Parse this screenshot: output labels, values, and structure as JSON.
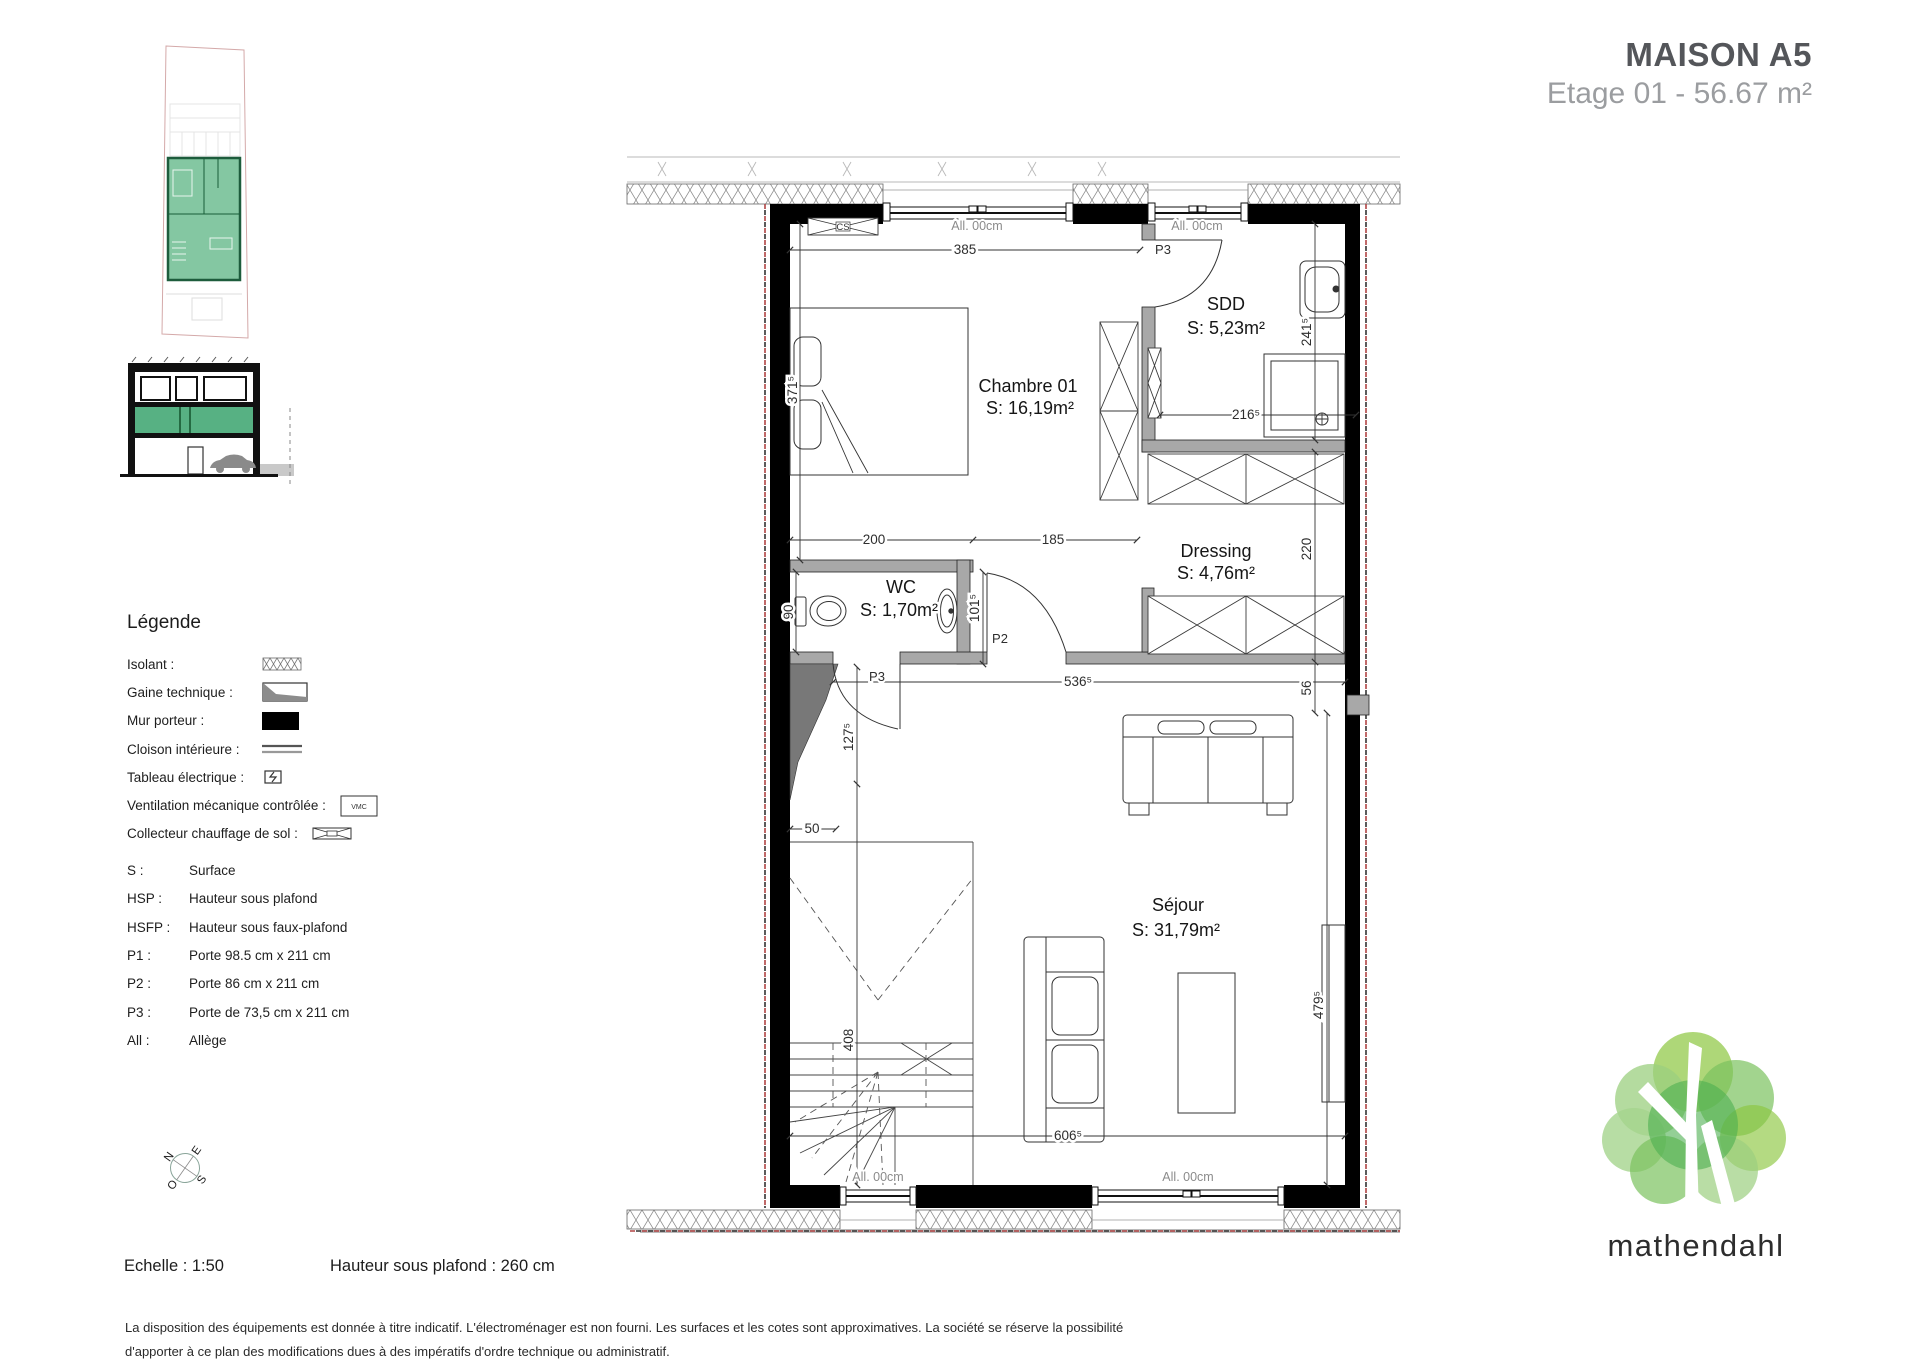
{
  "header": {
    "title": "MAISON A5",
    "subtitle": "Etage 01 - 56.67 m²"
  },
  "legend": {
    "heading": "Légende",
    "symbols": [
      {
        "label": "Isolant :"
      },
      {
        "label": "Gaine technique :"
      },
      {
        "label": "Mur porteur :"
      },
      {
        "label": "Cloison intérieure :"
      },
      {
        "label": "Tableau électrique :"
      },
      {
        "label": "Ventilation mécanique contrôlée :"
      },
      {
        "label": "Collecteur chauffage de sol :"
      }
    ],
    "vmc": "VMC",
    "abbreviations": [
      {
        "key": "S :",
        "value": "Surface"
      },
      {
        "key": "HSP :",
        "value": "Hauteur sous plafond"
      },
      {
        "key": "HSFP :",
        "value": "Hauteur sous faux-plafond"
      },
      {
        "key": "P1 :",
        "value": "Porte 98.5 cm x 211 cm"
      },
      {
        "key": "P2 :",
        "value": "Porte 86 cm x 211 cm"
      },
      {
        "key": "P3 :",
        "value": "Porte de 73,5 cm x 211 cm"
      },
      {
        "key": "All :",
        "value": "Allège"
      }
    ]
  },
  "plan": {
    "rooms": [
      {
        "name": "Chambre 01",
        "surface": "S: 16,19m²"
      },
      {
        "name": "SDD",
        "surface": "S: 5,23m²"
      },
      {
        "name": "WC",
        "surface": "S: 1,70m²"
      },
      {
        "name": "Dressing",
        "surface": "S: 4,76m²"
      },
      {
        "name": "Séjour",
        "surface": "S: 31,79m²"
      }
    ],
    "doors": {
      "p3_sdd": "P3",
      "p2": "P2",
      "p3_wc": "P3"
    },
    "windows": {
      "top_left": "All. 00cm",
      "top_right": "All. 00cm",
      "bottom_left": "All. 00cm",
      "bottom_right": "All. 00cm"
    },
    "dims": {
      "d385": "385",
      "d371": "371⁵",
      "d241": "241⁵",
      "d216": "216⁵",
      "d200": "200",
      "d185": "185",
      "d90": "90",
      "d101": "101⁵",
      "d220": "220",
      "d536": "536⁵",
      "d56": "56",
      "d479": "479⁵",
      "d127": "127⁵",
      "d50": "50",
      "d408": "408",
      "d606": "606⁵"
    },
    "cs_label": "CS"
  },
  "compass": {
    "n": "N",
    "e": "E",
    "s": "S",
    "o": "O"
  },
  "footer": {
    "scale": "Echelle : 1:50",
    "ceiling": "Hauteur sous plafond : 260 cm",
    "disclaimer_line1": "La disposition des équipements est donnée à titre indicatif. L'électroménager est non fourni. Les surfaces et les cotes sont approximatives. La société se réserve la possibilité",
    "disclaimer_line2": "d'apporter à ce plan des modifications dues à des impératifs d'ordre technique ou administratif."
  },
  "logo": {
    "wordmark": "mathendahl"
  },
  "colors": {
    "accent_green": "#57b183",
    "wall": "#000000",
    "partition": "#a8a8a8",
    "dash_red": "#b04343"
  }
}
